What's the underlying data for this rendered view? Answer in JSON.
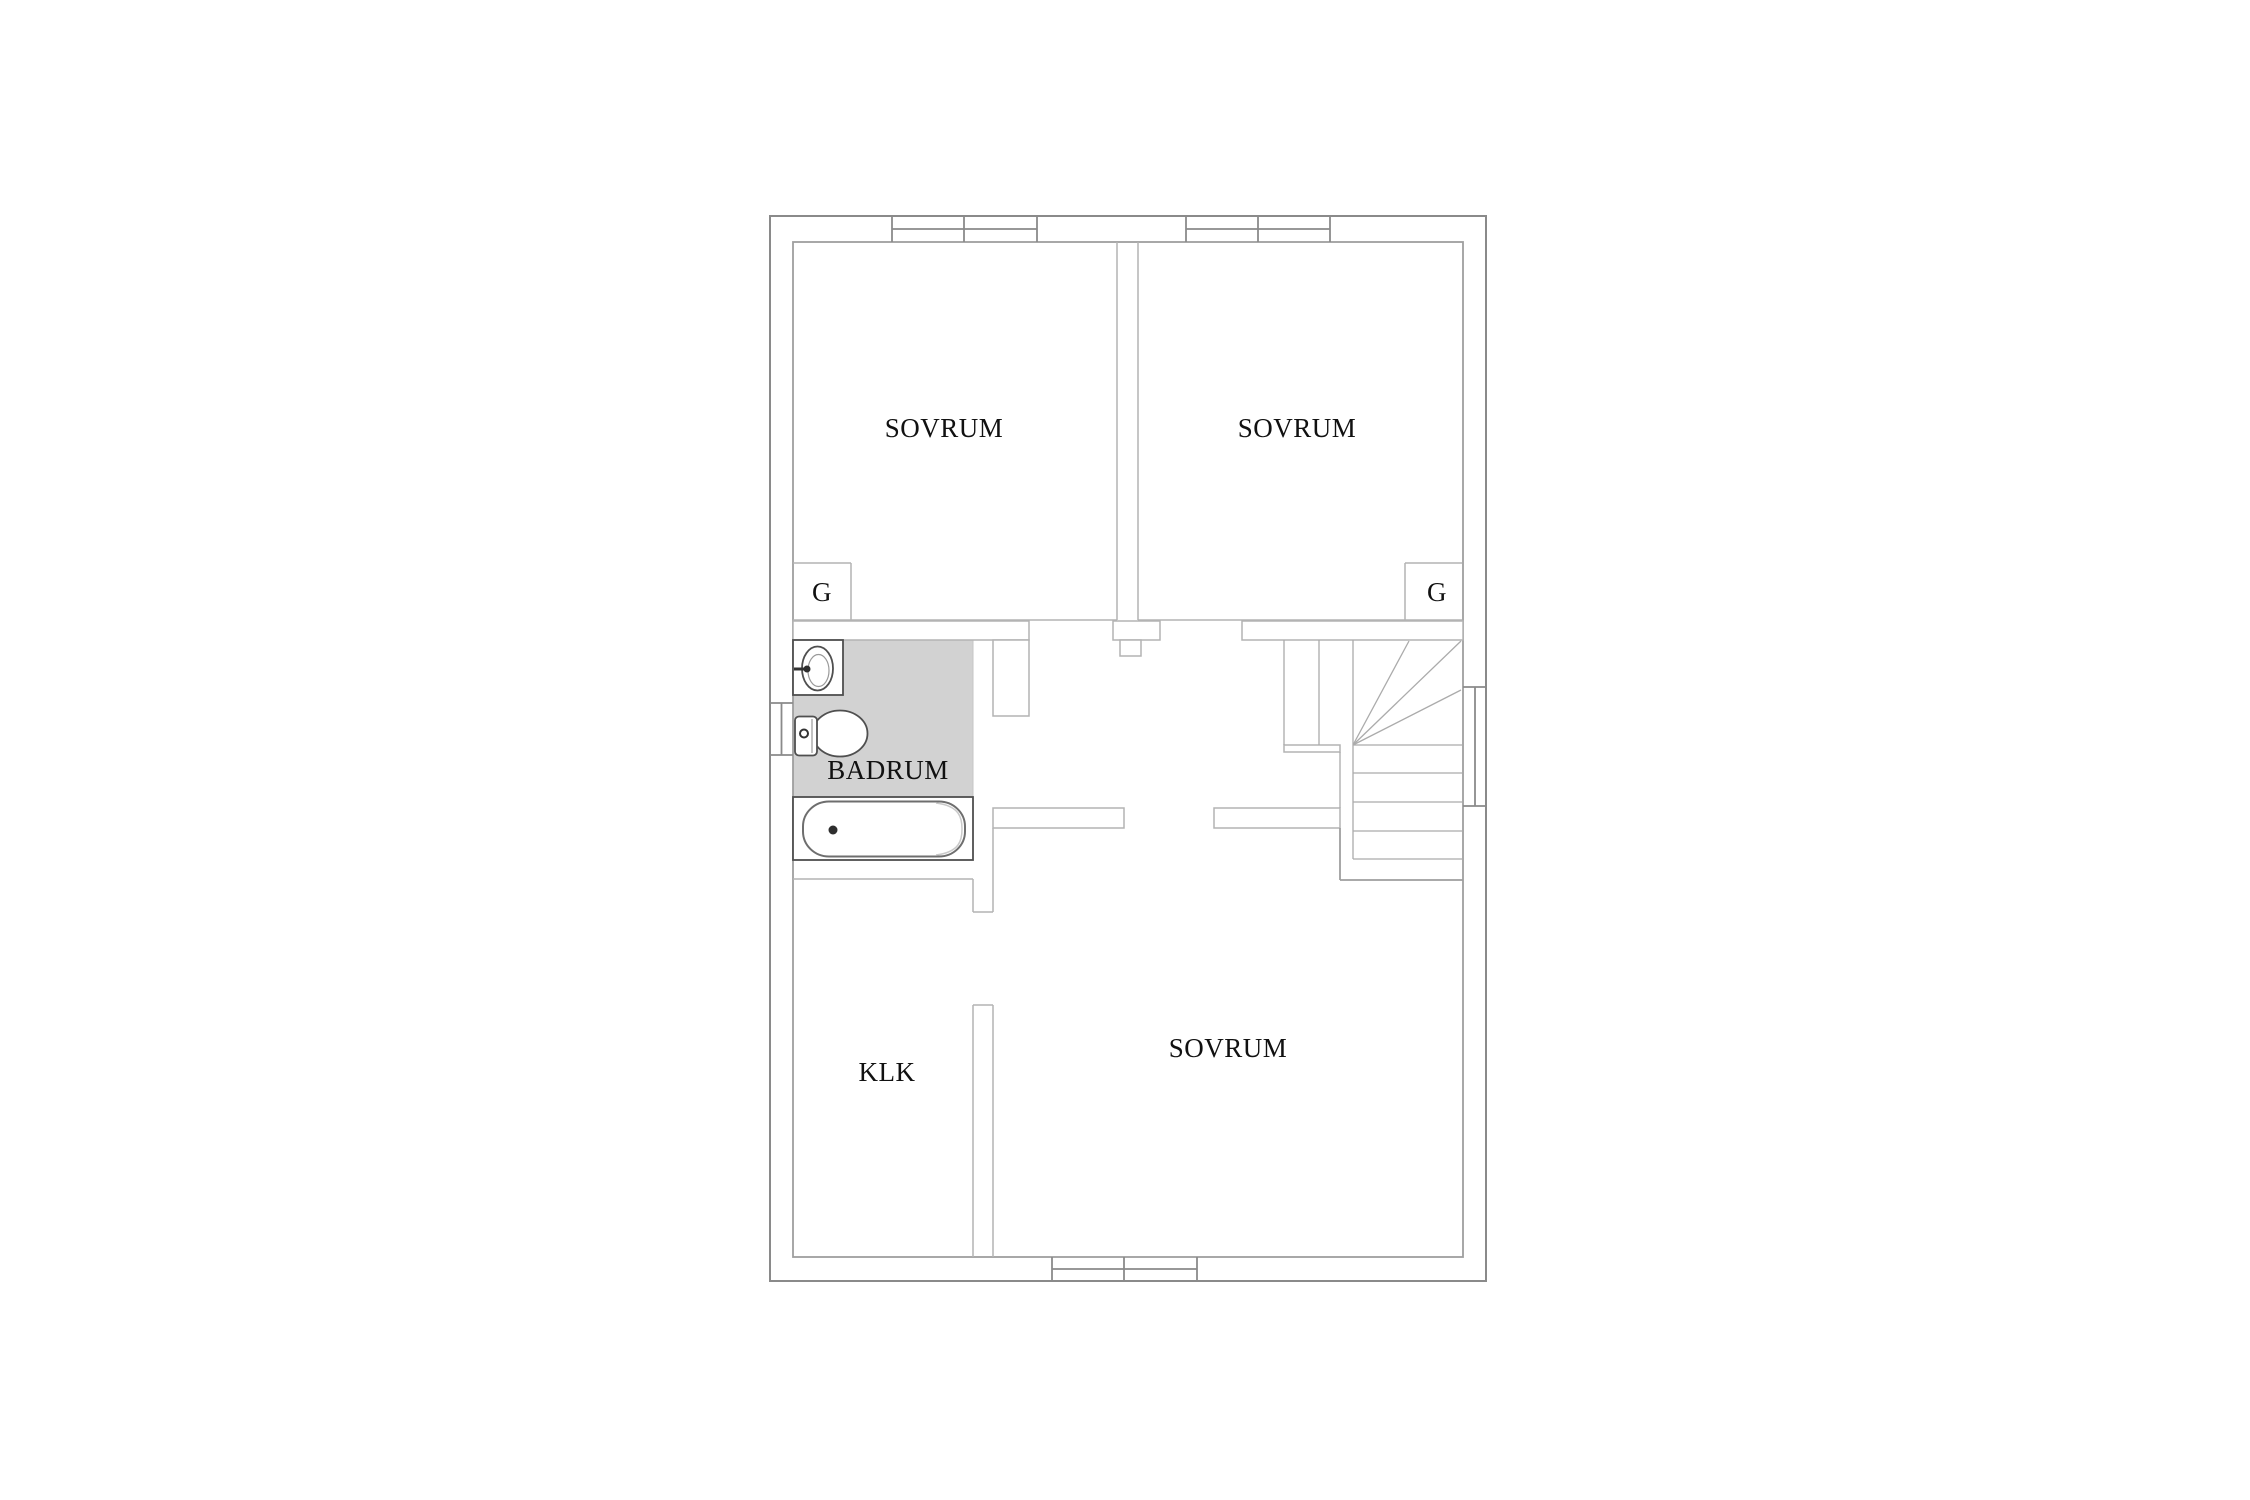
{
  "floorplan": {
    "type": "residential-floor-plan",
    "language": "sv",
    "colors": {
      "wall_line": "#8a8a8a",
      "inner_line": "#9e9e9e",
      "thin_line": "#b3b3b3",
      "stair_line": "#ababab",
      "fixture_line": "#4f4f4f",
      "fixture_soft": "#9a9a9a",
      "bathroom_fill": "#d2d2d2",
      "text_color": "#111111",
      "background": "#ffffff"
    },
    "room_labels": [
      {
        "id": "sovrum-1",
        "text": "SOVRUM",
        "x": 944,
        "y": 428
      },
      {
        "id": "sovrum-2",
        "text": "SOVRUM",
        "x": 1297,
        "y": 428
      },
      {
        "id": "sovrum-3",
        "text": "SOVRUM",
        "x": 1228,
        "y": 1048
      },
      {
        "id": "badrum",
        "text": "BADRUM",
        "x": 888,
        "y": 770
      },
      {
        "id": "klk",
        "text": "KLK",
        "x": 887,
        "y": 1072
      },
      {
        "id": "garderob-1",
        "text": "G",
        "x": 822,
        "y": 592
      },
      {
        "id": "garderob-2",
        "text": "G",
        "x": 1437,
        "y": 592
      }
    ],
    "fixtures": [
      {
        "id": "sink-icon",
        "room": "badrum"
      },
      {
        "id": "toilet-icon",
        "room": "badrum"
      },
      {
        "id": "bathtub-icon",
        "room": "badrum"
      },
      {
        "id": "stairs-icon",
        "room": "hall"
      }
    ]
  }
}
